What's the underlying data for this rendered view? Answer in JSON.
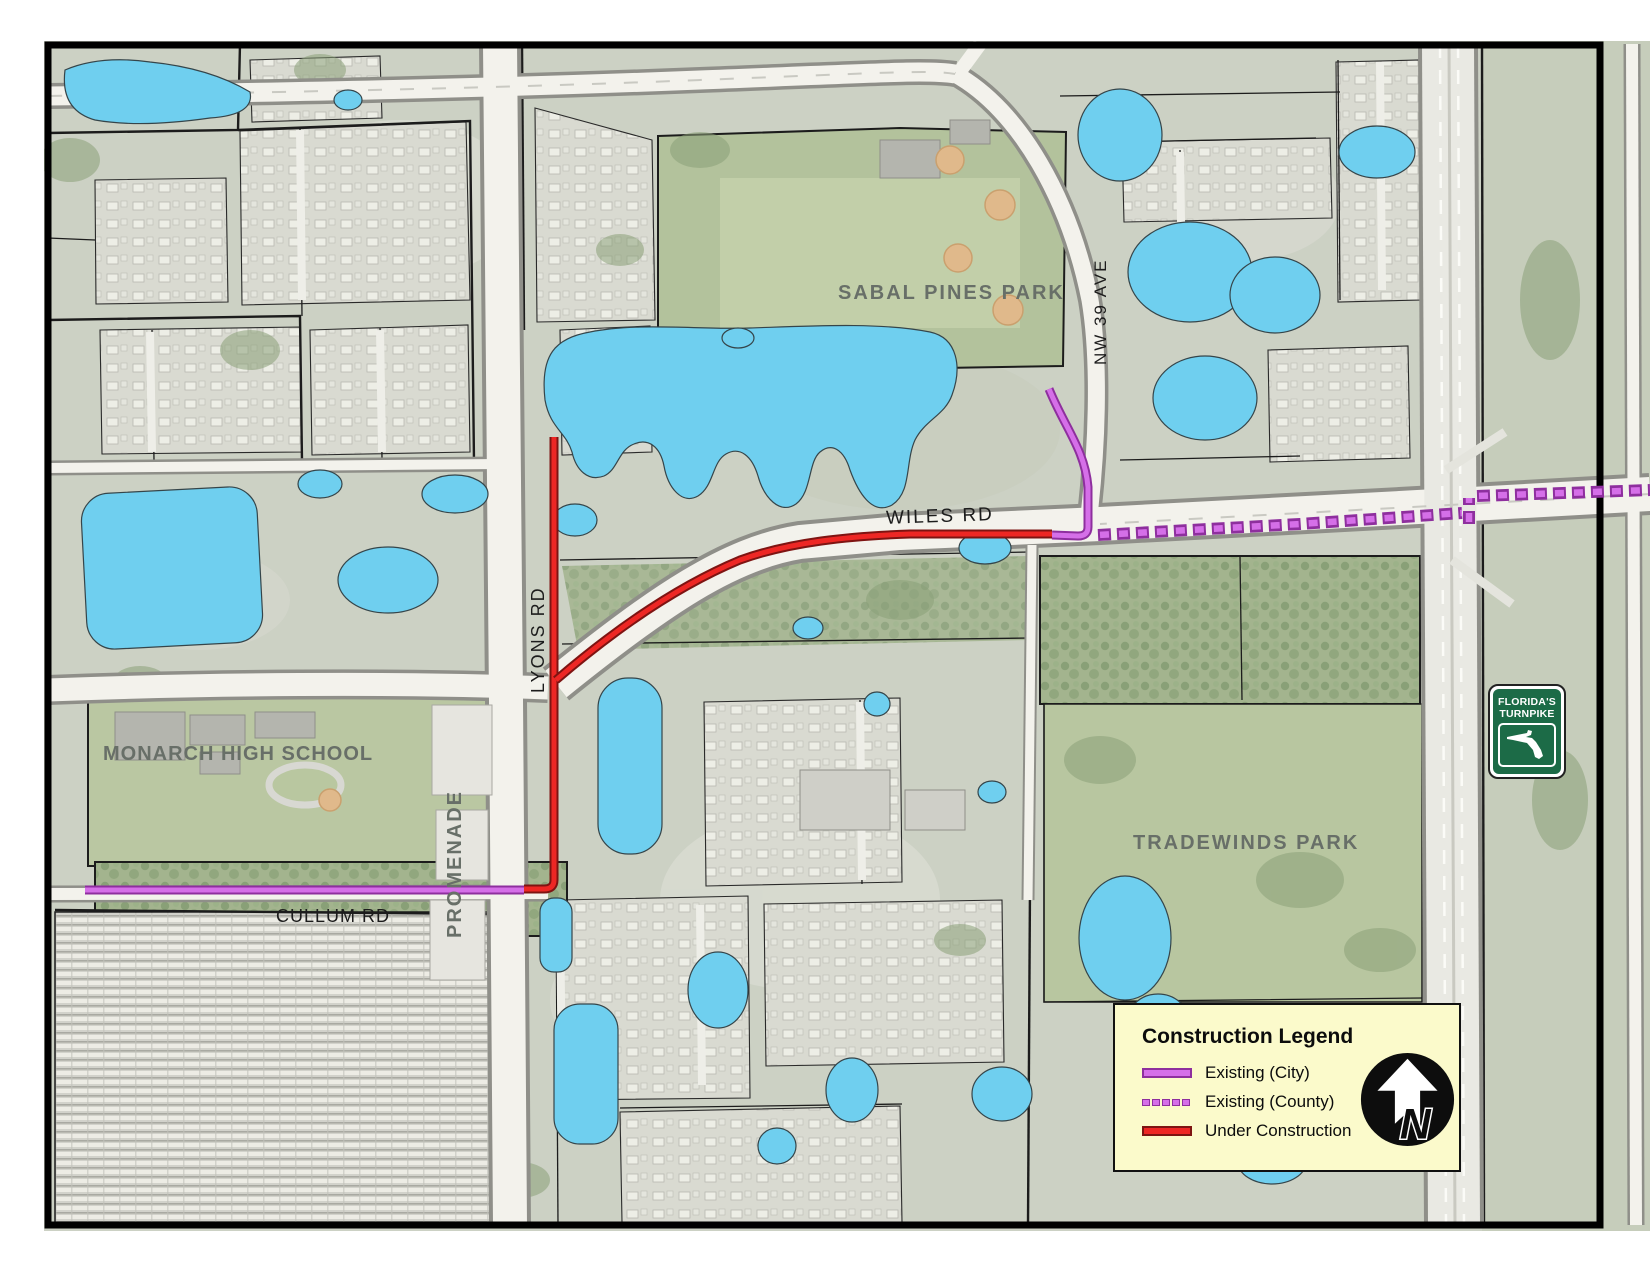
{
  "map_labels": {
    "sabal_pines_park": "SABAL PINES PARK",
    "nw_39_ave": "NW 39 AVE",
    "wiles_rd": "WILES RD",
    "lyons_rd": "LYONS RD",
    "monarch_high_school": "MONARCH HIGH SCHOOL",
    "promenade": "PROMENADE",
    "cullum_rd": "CULLUM RD",
    "tradewinds_park": "TRADEWINDS PARK"
  },
  "turnpike_shield": {
    "line1": "FLORIDA'S",
    "line2": "TURNPIKE"
  },
  "legend": {
    "title": "Construction Legend",
    "items": [
      {
        "label": "Existing (City)",
        "style": "solid-purple"
      },
      {
        "label": "Existing (County)",
        "style": "dashed-purple"
      },
      {
        "label": "Under Construction",
        "style": "solid-red"
      }
    ],
    "north_label": "N"
  },
  "colors": {
    "existing_city": "#d56fe8",
    "existing_county": "#d56fe8",
    "under_construction": "#ed2724",
    "legend_background": "#fbfacb",
    "water": "#6fcfef",
    "turnpike_sign_green": "#1c6b47"
  }
}
